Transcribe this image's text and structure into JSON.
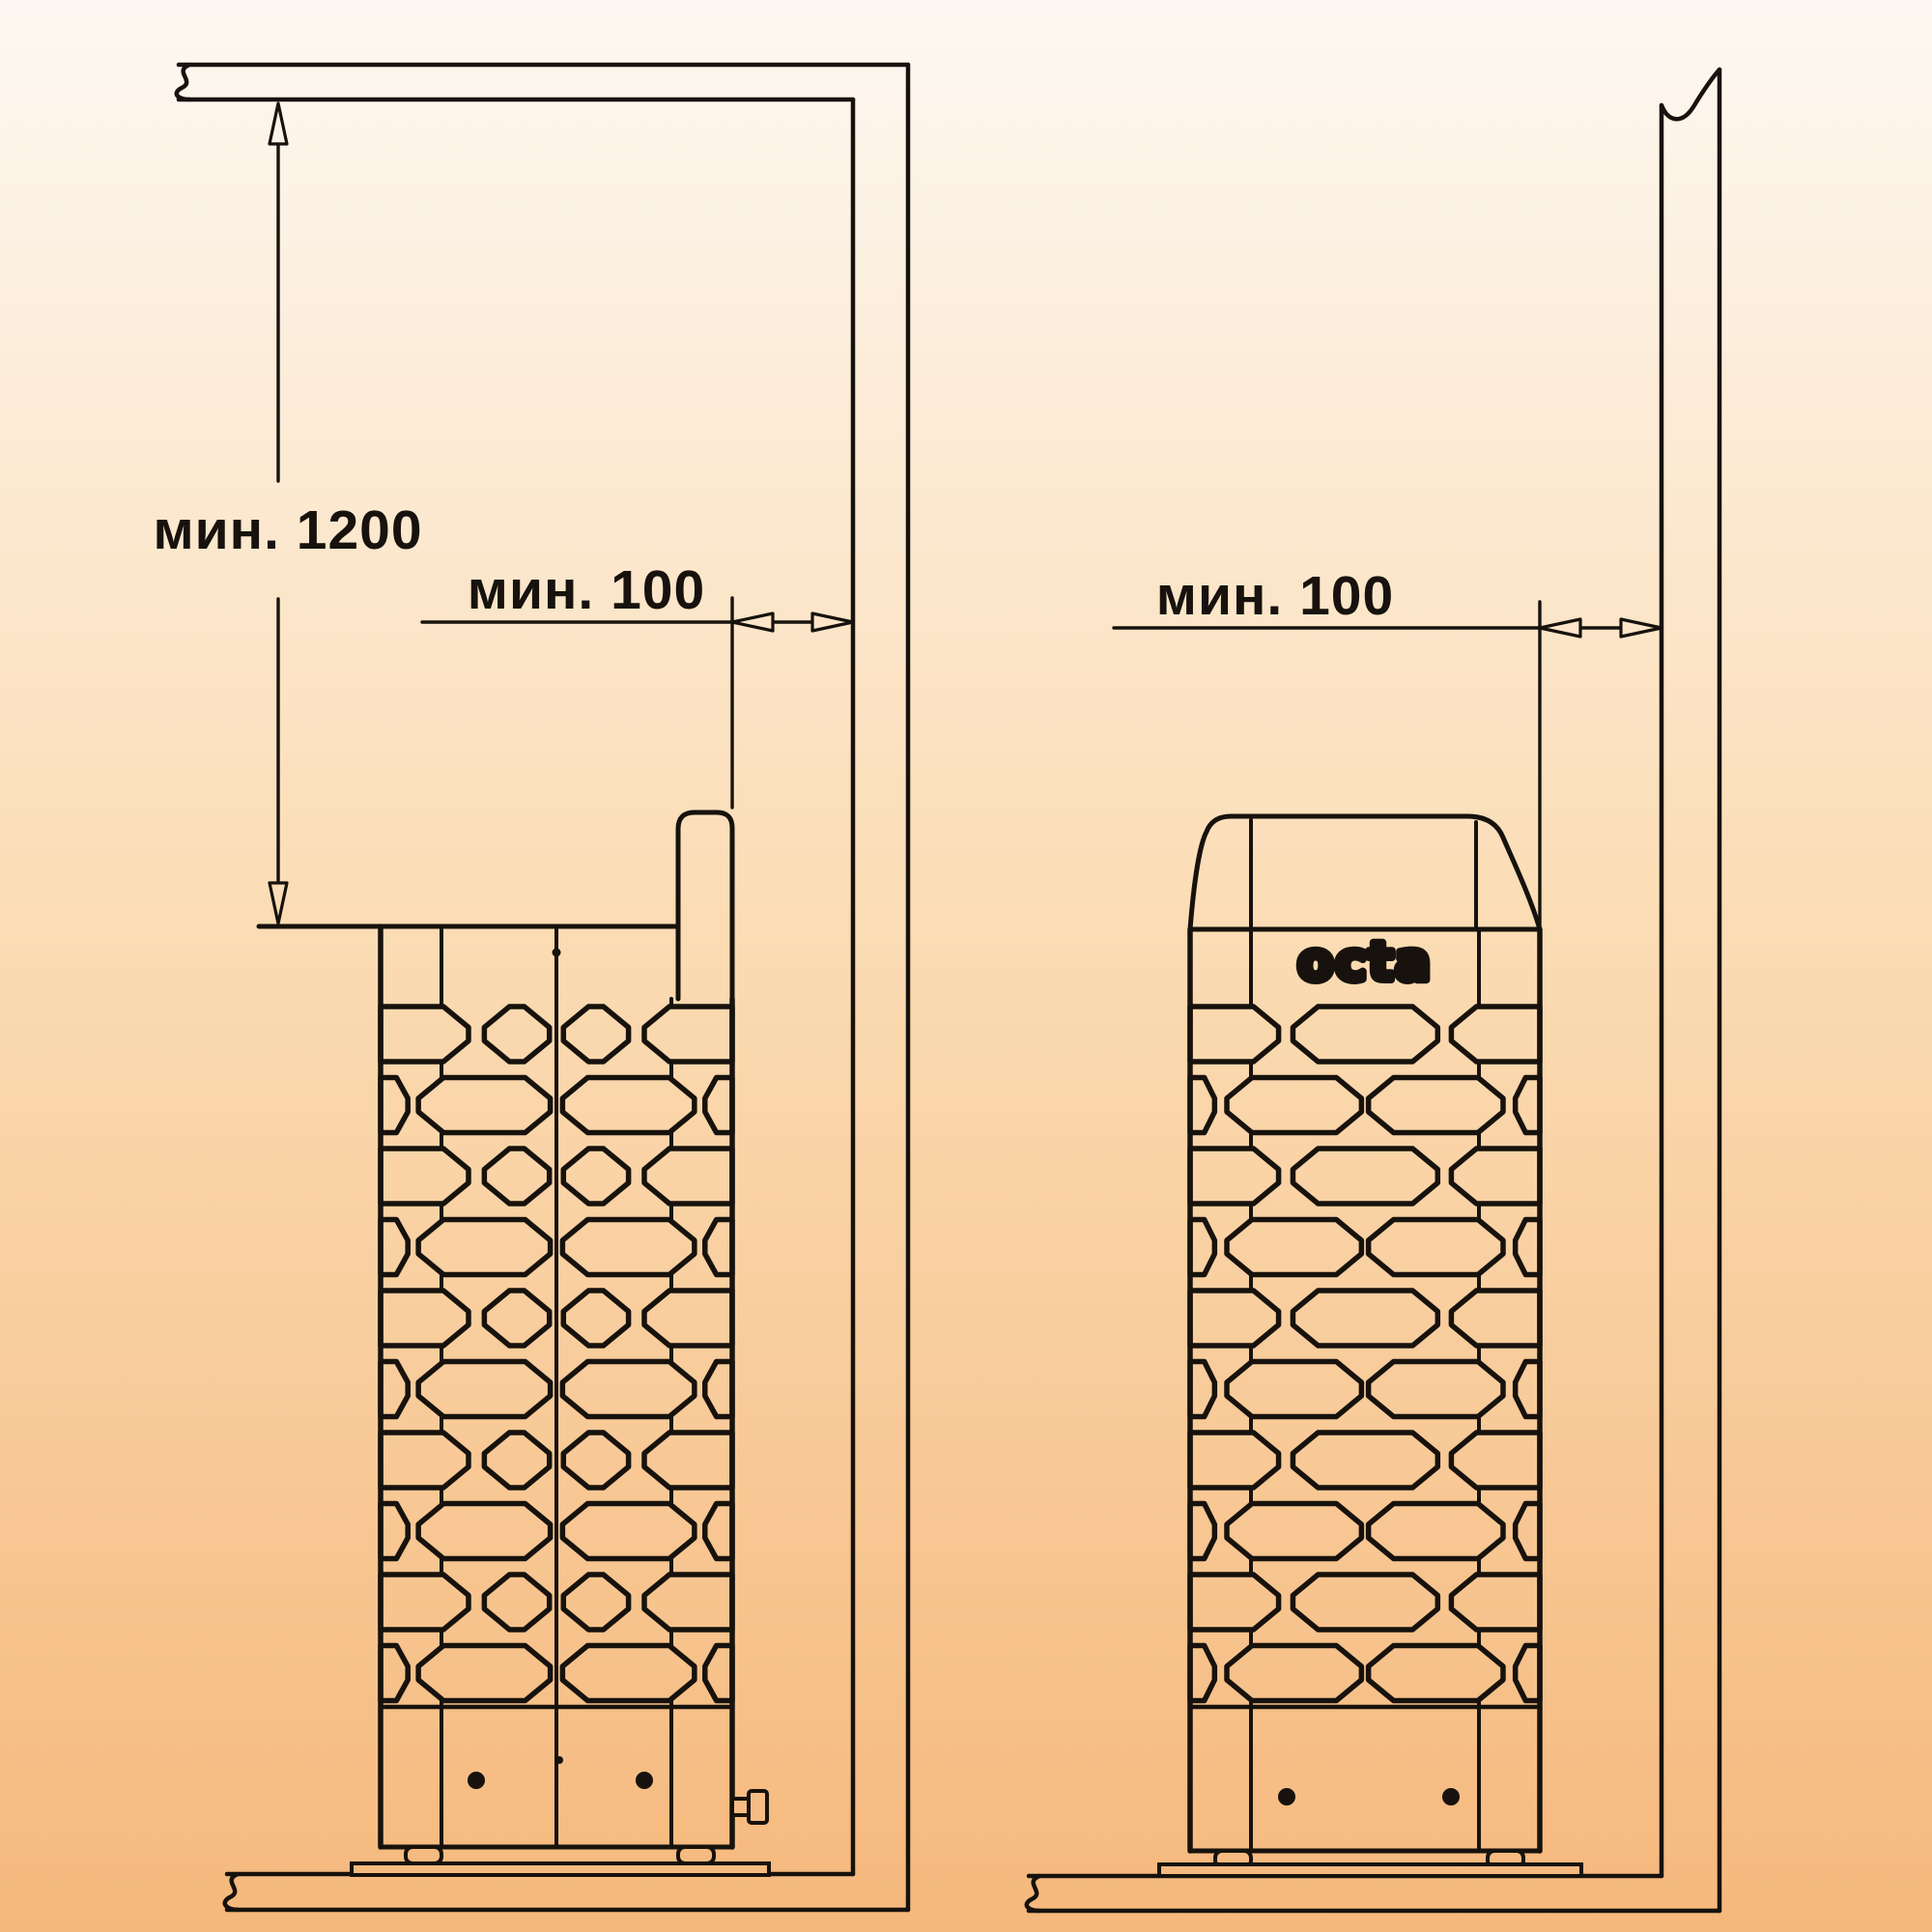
{
  "diagram": {
    "description": "sauna heater installation clearance drawing, two views",
    "labels": {
      "min_height": "мин. 1200",
      "min_gap_left": "мин. 100",
      "min_gap_right": "мин. 100"
    },
    "brand": {
      "logo": "octa"
    },
    "dimensions_mm": {
      "min_distance_heater_top_to_ceiling": 1200,
      "min_distance_heater_to_wall": 100
    },
    "colors": {
      "background_top": "#fdf8f2",
      "background_middle": "#fbdcb4",
      "background_bottom": "#f5b87c",
      "line": "#17120d",
      "text": "#17120d"
    }
  }
}
